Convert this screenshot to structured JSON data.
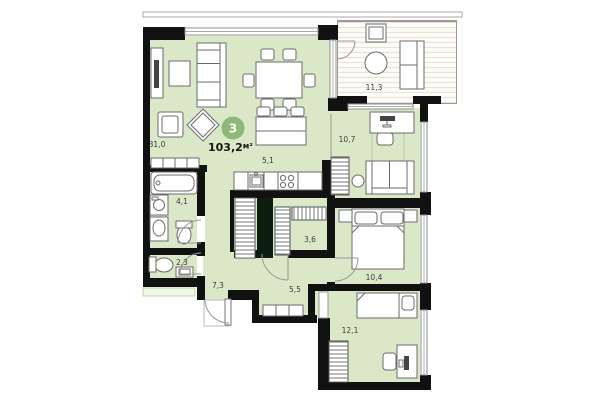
{
  "floorplan": {
    "badge": {
      "room_count": "3"
    },
    "total_area": "103,2",
    "total_area_unit": "м²",
    "rooms": [
      {
        "name": "living-room",
        "area": "31,0"
      },
      {
        "name": "kitchen",
        "area": "5,1"
      },
      {
        "name": "balcony",
        "area": "11,3"
      },
      {
        "name": "study",
        "area": "10,7"
      },
      {
        "name": "bathroom",
        "area": "4,1"
      },
      {
        "name": "closet",
        "area": "3,6"
      },
      {
        "name": "bedroom",
        "area": "10,4"
      },
      {
        "name": "wc",
        "area": "2,3"
      },
      {
        "name": "hall",
        "area": "7,3"
      },
      {
        "name": "corridor",
        "area": "5,5"
      },
      {
        "name": "kids-room",
        "area": "12,1"
      }
    ],
    "colors": {
      "room_fill": "#dbe8c8",
      "wall": "#111111",
      "badge_green": "#8cb878",
      "dark_storage": "#0d1d10",
      "balcony_stripe": "#eae2d3",
      "label_text": "#3d3d3d"
    }
  }
}
